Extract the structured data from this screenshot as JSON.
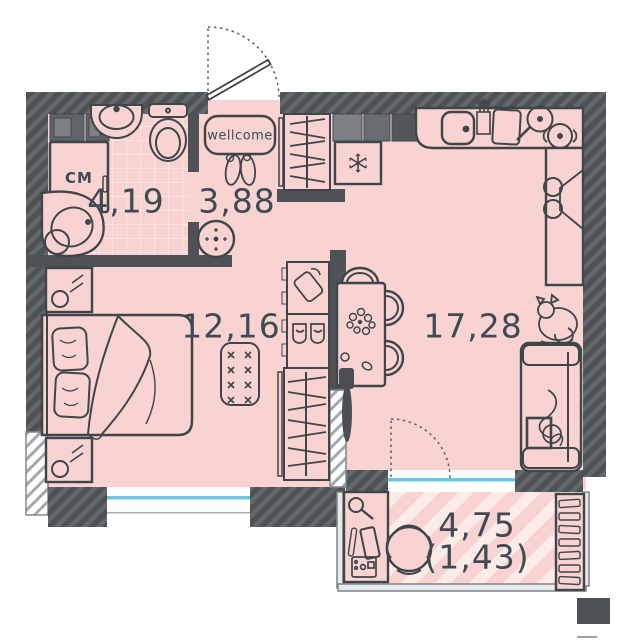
{
  "title": "apartment-floor-plan",
  "colors": {
    "background": "#ffffff",
    "floor_pink": "#f8d3d1",
    "wall_dark": "#4e5255",
    "wall_hatch": "#63686c",
    "outline": "#3f4549",
    "window_glass": "#6cc6e0",
    "label_text": "#3f4a52",
    "cabinet_dark": "#53575b",
    "cabinet_mid": "#696d71",
    "cabinet_light": "#7d8185"
  },
  "rooms": {
    "bathroom": {
      "area": "4,19",
      "washer_label": "СМ",
      "fixtures": [
        "corner-bathtub",
        "washbasin",
        "toilet",
        "washing-machine",
        "wall-cabinets",
        "tiled-floor"
      ]
    },
    "hallway": {
      "area": "3,88",
      "doormat_text": "wellcome",
      "fixtures": [
        "entrance-door",
        "doormat",
        "shoes",
        "wardrobe-with-hangers",
        "pouf"
      ]
    },
    "bedroom": {
      "area": "12,16",
      "fixtures": [
        "double-bed",
        "pillows",
        "nightstand",
        "nightstand",
        "ottoman",
        "bag-cabinet",
        "shoe-cabinet",
        "wardrobe-with-hangers",
        "window"
      ]
    },
    "living_kitchen": {
      "area": "17,28",
      "fixtures": [
        "kitchen-cabinets",
        "fridge-snowflake",
        "kitchen-counter",
        "kitchen-sink",
        "faucet",
        "cutting-board",
        "frying-pan",
        "pot",
        "oven-stove",
        "dining-table",
        "flowers",
        "chairs",
        "tv",
        "sofa",
        "cat",
        "balcony-door"
      ]
    },
    "balcony": {
      "area": "4,75",
      "area_reduced": "(1,43)",
      "fixtures": [
        "desk",
        "desk-lamp",
        "tablet",
        "pc-tower",
        "office-chair",
        "shelving-unit",
        "striped-floor"
      ]
    }
  }
}
